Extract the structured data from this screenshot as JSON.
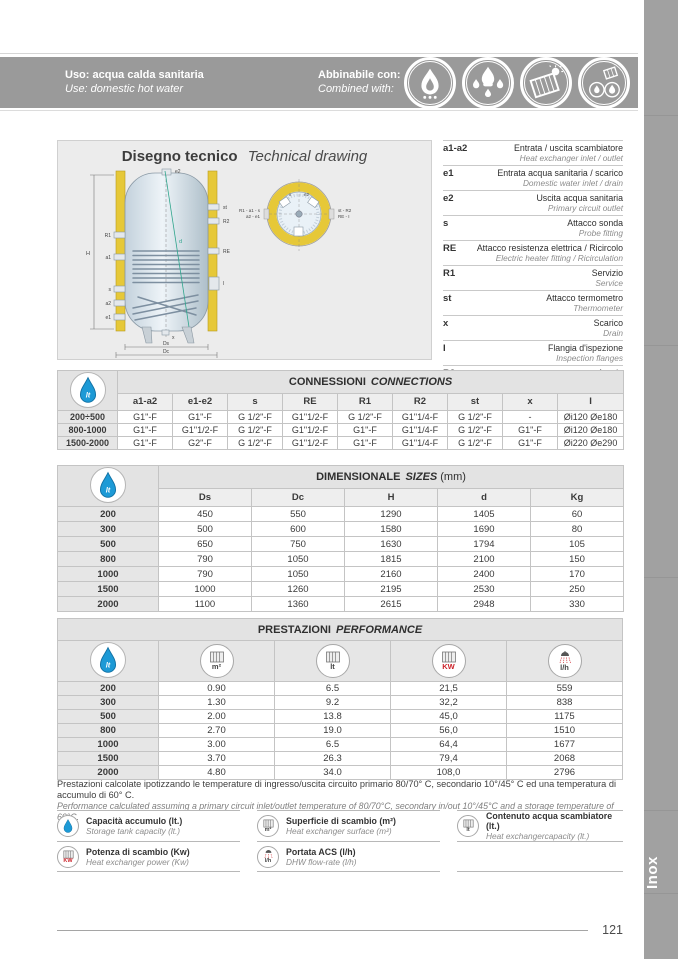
{
  "header": {
    "use_it": "Uso: acqua calda sanitaria",
    "use_en": "Use: domestic hot water",
    "combined_it": "Abbinabile con:",
    "combined_en": "Combined with:"
  },
  "drawing": {
    "title_it": "Disegno tecnico",
    "title_en": "Technical drawing",
    "lbl": {
      "e2": "e2",
      "x": "x",
      "d": "d",
      "H": "H",
      "Ds": "Ds",
      "Dc": "Dc"
    },
    "front_left": [
      "R1",
      "a1",
      "s",
      "a2",
      "e1"
    ],
    "front_right": [
      "st",
      "R2",
      "RE",
      "I"
    ],
    "topview": {
      "left1": "R1 - a1 - s",
      "left2": "a2 - e1",
      "right1": "st - R2",
      "right2": "RE - I",
      "top1": "x",
      "top2": "e2"
    }
  },
  "legend": {
    "items": [
      {
        "code": "a1-a2",
        "it": "Entrata / uscita scambiatore",
        "en": "Heat exchanger inlet / outlet"
      },
      {
        "code": "e1",
        "it": "Entrata acqua sanitaria / scarico",
        "en": "Domestic water inlet / drain"
      },
      {
        "code": "e2",
        "it": "Uscita acqua sanitaria",
        "en": "Primary circuit outlet"
      },
      {
        "code": "s",
        "it": "Attacco sonda",
        "en": "Probe fitting"
      },
      {
        "code": "RE",
        "it": "Attacco resistenza elettrica / Ricircolo",
        "en": "Electric heater fitting / Ricirculation"
      },
      {
        "code": "R1",
        "it": "Servizio",
        "en": "Service"
      },
      {
        "code": "st",
        "it": "Attacco termometro",
        "en": "Thermometer"
      },
      {
        "code": "x",
        "it": "Scarico",
        "en": "Drain"
      },
      {
        "code": "I",
        "it": "Flangia d'ispezione",
        "en": "Inspection flanges"
      },
      {
        "code": "R2",
        "it": "Anodo",
        "en": "Anode"
      }
    ]
  },
  "connections": {
    "title_it": "CONNESSIONI",
    "title_en": "CONNECTIONS",
    "columns": [
      "a1-a2",
      "e1-e2",
      "s",
      "RE",
      "R1",
      "R2",
      "st",
      "x",
      "I"
    ],
    "rows": [
      {
        "label": "200÷500",
        "cells": [
          "G1\"-F",
          "G1\"-F",
          "G 1/2\"-F",
          "G1\"1/2-F",
          "G 1/2\"-F",
          "G1\"1/4-F",
          "G 1/2\"-F",
          "-",
          "Øi120 Øe180"
        ]
      },
      {
        "label": "800-1000",
        "cells": [
          "G1\"-F",
          "G1\"1/2-F",
          "G 1/2\"-F",
          "G1\"1/2-F",
          "G1\"-F",
          "G1\"1/4-F",
          "G 1/2\"-F",
          "G1\"-F",
          "Øi120 Øe180"
        ]
      },
      {
        "label": "1500-2000",
        "cells": [
          "G1\"-F",
          "G2\"-F",
          "G 1/2\"-F",
          "G1\"1/2-F",
          "G1\"-F",
          "G1\"1/4-F",
          "G 1/2\"-F",
          "G1\"-F",
          "Øi220 Øe290"
        ]
      }
    ]
  },
  "dimensional": {
    "title_it": "DIMENSIONALE",
    "title_en": "SIZES",
    "unit": "(mm)",
    "columns": [
      "Ds",
      "Dc",
      "H",
      "d",
      "Kg"
    ],
    "rows": [
      {
        "label": "200",
        "cells": [
          "450",
          "550",
          "1290",
          "1405",
          "60"
        ]
      },
      {
        "label": "300",
        "cells": [
          "500",
          "600",
          "1580",
          "1690",
          "80"
        ]
      },
      {
        "label": "500",
        "cells": [
          "650",
          "750",
          "1630",
          "1794",
          "105"
        ]
      },
      {
        "label": "800",
        "cells": [
          "790",
          "1050",
          "1815",
          "2100",
          "150"
        ]
      },
      {
        "label": "1000",
        "cells": [
          "790",
          "1050",
          "2160",
          "2400",
          "170"
        ]
      },
      {
        "label": "1500",
        "cells": [
          "1000",
          "1260",
          "2195",
          "2530",
          "250"
        ]
      },
      {
        "label": "2000",
        "cells": [
          "1100",
          "1360",
          "2615",
          "2948",
          "330"
        ]
      }
    ]
  },
  "performance": {
    "title_it": "PRESTAZIONI",
    "title_en": "PERFORMANCE",
    "units": [
      "m²",
      "lt",
      "KW",
      "l/h"
    ],
    "rows": [
      {
        "label": "200",
        "cells": [
          "0.90",
          "6.5",
          "21,5",
          "559"
        ]
      },
      {
        "label": "300",
        "cells": [
          "1.30",
          "9.2",
          "32,2",
          "838"
        ]
      },
      {
        "label": "500",
        "cells": [
          "2.00",
          "13.8",
          "45,0",
          "1175"
        ]
      },
      {
        "label": "800",
        "cells": [
          "2.70",
          "19.0",
          "56,0",
          "1510"
        ]
      },
      {
        "label": "1000",
        "cells": [
          "3.00",
          "6.5",
          "64,4",
          "1677"
        ]
      },
      {
        "label": "1500",
        "cells": [
          "3.70",
          "26.3",
          "79,4",
          "2068"
        ]
      },
      {
        "label": "2000",
        "cells": [
          "4.80",
          "34.0",
          "108,0",
          "2796"
        ]
      }
    ]
  },
  "notes": {
    "it": "Prestazioni calcolate ipotizzando le temperature di ingresso/uscita circuito primario 80/70° C, secondario 10°/45° C ed una temperatura di accumulo di 60° C.",
    "en": "Performance calculated assuming a primary circuit inlet/outlet temperature of 80/70°C, secondary in/out 10°/45°C and a storage temperature of 60°C."
  },
  "bottom_legend": {
    "items": [
      {
        "it": "Capacità accumulo (lt.)",
        "en": "Storage tank capacity (lt.)"
      },
      {
        "it": "Superficie di scambio (m²)",
        "en": "Heat exchanger surface (m²)"
      },
      {
        "it": "Contenuto acqua scambiatore (lt.)",
        "en": "Heat exchangercapacity (lt.)"
      },
      {
        "it": "Potenza di scambio (Kw)",
        "en": "Heat exchanger power (Kw)"
      },
      {
        "it": "Portata ACS (l/h)",
        "en": "DHW flow-rate (l/h)"
      }
    ]
  },
  "icons": {
    "droplet_label": "lt"
  },
  "footer": {
    "page_number": "121",
    "side_tab": "Inox"
  },
  "colors": {
    "band_gray": "#9a9a9a",
    "accent_blue": "#1d9ad6",
    "accent_red": "#cc2229",
    "insulation_yellow": "#e6c838"
  }
}
